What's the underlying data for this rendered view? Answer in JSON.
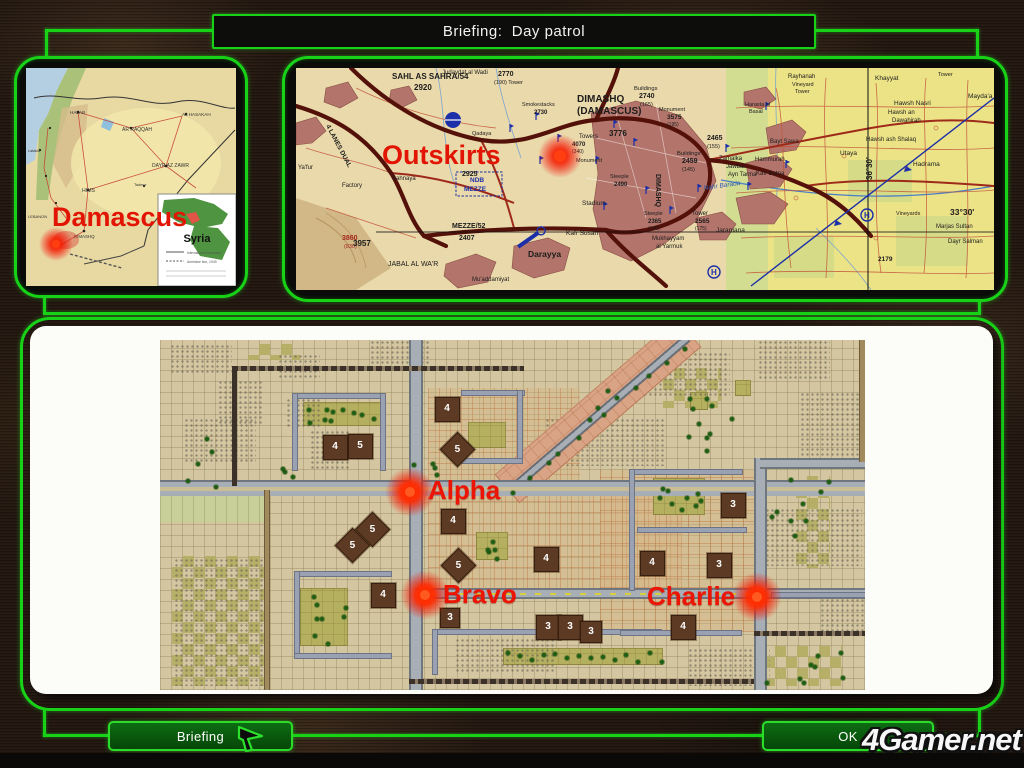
{
  "title": "Briefing:  Day patrol",
  "buttons": {
    "briefing": "Briefing",
    "ok": "OK"
  },
  "watermark": "4Gamer.net",
  "colors": {
    "frame_green": "#18d218",
    "marker_red": "#ec1505",
    "map_tan": "#d3c6a0"
  },
  "syria": {
    "marker": "Damascus",
    "inset": {
      "title": "Syria",
      "legend1": "International boundary",
      "legend2": "Armistice line, 1949"
    },
    "labels": [
      {
        "t": "HALAB",
        "x": 44,
        "y": 46,
        "s": 4.6
      },
      {
        "t": "AR RAQQAH",
        "x": 96,
        "y": 63,
        "s": 5
      },
      {
        "t": "AL HASAKAH",
        "x": 156,
        "y": 48,
        "s": 4.6
      },
      {
        "t": "DAYR AZ ZAWR",
        "x": 126,
        "y": 99,
        "s": 5
      },
      {
        "t": "HIMS",
        "x": 56,
        "y": 124,
        "s": 5.2
      },
      {
        "t": "DIMASHQ",
        "x": 48,
        "y": 170,
        "s": 4.4
      },
      {
        "t": "LEBANON",
        "x": 2,
        "y": 150,
        "s": 4
      },
      {
        "t": "Latakia",
        "x": 2,
        "y": 84,
        "s": 3.8
      },
      {
        "t": "Tadmur",
        "x": 108,
        "y": 118,
        "s": 3.8
      }
    ]
  },
  "detail": {
    "marker": "Outskirts",
    "labels": [
      {
        "t": "SAHL AS SAHRA/54",
        "x": 96,
        "y": 11,
        "s": 8,
        "b": 1
      },
      {
        "t": "2920",
        "x": 118,
        "y": 22,
        "s": 8,
        "b": 1
      },
      {
        "t": "Judaydat al Wadi",
        "x": 146,
        "y": 6,
        "s": 6
      },
      {
        "t": "2770",
        "x": 202,
        "y": 8,
        "s": 7,
        "b": 1
      },
      {
        "t": "(190) Tower",
        "x": 198,
        "y": 16,
        "s": 5.5
      },
      {
        "t": "4 LANES DUAL",
        "x": 30,
        "y": 58,
        "s": 6.5,
        "b": 1,
        "r": 62
      },
      {
        "t": "Factory",
        "x": 46,
        "y": 119,
        "s": 6
      },
      {
        "t": "Ya'fur",
        "x": 2,
        "y": 101,
        "s": 6
      },
      {
        "t": "3860",
        "x": 46,
        "y": 172,
        "s": 7,
        "b": 1,
        "c": "#a3261c"
      },
      {
        "t": "(830)",
        "x": 48,
        "y": 180,
        "s": 5.5,
        "c": "#a3261c"
      },
      {
        "t": "Sahnaya",
        "x": 96,
        "y": 112,
        "s": 6
      },
      {
        "t": "Qadaya",
        "x": 176,
        "y": 67,
        "s": 5.5
      },
      {
        "t": "Smokestacks",
        "x": 226,
        "y": 38,
        "s": 5.5
      },
      {
        "t": "2730",
        "x": 238,
        "y": 46,
        "s": 6,
        "b": 1
      },
      {
        "t": "2925",
        "x": 166,
        "y": 108,
        "s": 7,
        "b": 1
      },
      {
        "t": "NDB",
        "x": 174,
        "y": 114,
        "s": 6.5,
        "b": 1,
        "c": "#1b2fa8"
      },
      {
        "t": "MEZZE",
        "x": 168,
        "y": 123,
        "s": 6.5,
        "b": 1,
        "c": "#1b2fa8"
      },
      {
        "t": "MEZZE/52",
        "x": 156,
        "y": 160,
        "s": 7,
        "b": 1
      },
      {
        "t": "2407",
        "x": 163,
        "y": 172,
        "s": 7,
        "b": 1
      },
      {
        "t": "3957",
        "x": 57,
        "y": 178,
        "s": 8,
        "b": 1
      },
      {
        "t": "JABAL AL WA'R",
        "x": 92,
        "y": 198,
        "s": 7
      },
      {
        "t": "Darayya",
        "x": 232,
        "y": 189,
        "s": 8.5,
        "b": 1
      },
      {
        "t": "Mu'addamiyat",
        "x": 176,
        "y": 213,
        "s": 6
      },
      {
        "t": "Stadium",
        "x": 286,
        "y": 137,
        "s": 6.5
      },
      {
        "t": "Kafr Susah",
        "x": 270,
        "y": 167,
        "s": 6.5
      },
      {
        "t": "DIMASHQ",
        "x": 281,
        "y": 34,
        "s": 10,
        "b": 1
      },
      {
        "t": "(DAMASCUS)",
        "x": 281,
        "y": 46,
        "s": 10,
        "b": 1
      },
      {
        "t": "Buildings",
        "x": 338,
        "y": 22,
        "s": 5.8
      },
      {
        "t": "2740",
        "x": 343,
        "y": 30,
        "s": 7,
        "b": 1
      },
      {
        "t": "(165)",
        "x": 344,
        "y": 38,
        "s": 5.5
      },
      {
        "t": "Towers",
        "x": 283,
        "y": 70,
        "s": 6
      },
      {
        "t": "3776",
        "x": 313,
        "y": 68,
        "s": 8,
        "b": 1
      },
      {
        "t": "4070",
        "x": 276,
        "y": 78,
        "s": 6,
        "b": 1
      },
      {
        "t": "(340)",
        "x": 276,
        "y": 85,
        "s": 5
      },
      {
        "t": "Monument",
        "x": 280,
        "y": 94,
        "s": 5.5
      },
      {
        "t": "Monument",
        "x": 363,
        "y": 43,
        "s": 5.5
      },
      {
        "t": "3575",
        "x": 371,
        "y": 51,
        "s": 6.5,
        "b": 1
      },
      {
        "t": "(195)",
        "x": 371,
        "y": 58,
        "s": 5
      },
      {
        "t": "Buildings",
        "x": 381,
        "y": 87,
        "s": 5.8
      },
      {
        "t": "2459",
        "x": 386,
        "y": 95,
        "s": 7,
        "b": 1
      },
      {
        "t": "(145)",
        "x": 386,
        "y": 103,
        "s": 5.5
      },
      {
        "t": "2465",
        "x": 411,
        "y": 72,
        "s": 7,
        "b": 1
      },
      {
        "t": "(155)",
        "x": 411,
        "y": 80,
        "s": 5.5
      },
      {
        "t": "Zamalka",
        "x": 423,
        "y": 92,
        "s": 6
      },
      {
        "t": "Jawbar",
        "x": 430,
        "y": 100,
        "s": 6
      },
      {
        "t": "Ayn Tarma",
        "x": 432,
        "y": 108,
        "s": 6
      },
      {
        "t": "DIMASHQ",
        "x": 360,
        "y": 106,
        "s": 7,
        "b": 1,
        "r": 90
      },
      {
        "t": "Mukhayyam",
        "x": 356,
        "y": 172,
        "s": 6
      },
      {
        "t": "al Yarmuk",
        "x": 360,
        "y": 180,
        "s": 6
      },
      {
        "t": "Steeple",
        "x": 314,
        "y": 110,
        "s": 5.5
      },
      {
        "t": "2490",
        "x": 318,
        "y": 118,
        "s": 6,
        "b": 1
      },
      {
        "t": "Steeple",
        "x": 348,
        "y": 147,
        "s": 5.5
      },
      {
        "t": "2365",
        "x": 352,
        "y": 155,
        "s": 6,
        "b": 1
      },
      {
        "t": "(140)",
        "x": 352,
        "y": 162,
        "s": 5
      },
      {
        "t": "Tower",
        "x": 396,
        "y": 147,
        "s": 6
      },
      {
        "t": "2565",
        "x": 399,
        "y": 155,
        "s": 6.5,
        "b": 1
      },
      {
        "t": "(175)",
        "x": 399,
        "y": 162,
        "s": 5
      },
      {
        "t": "Jaramana",
        "x": 420,
        "y": 164,
        "s": 6.5
      },
      {
        "t": "Nahr Barada",
        "x": 408,
        "y": 122,
        "s": 6.5,
        "c": "#2a5cb0",
        "i": 1,
        "r": -8
      },
      {
        "t": "Harasta al",
        "x": 449,
        "y": 38,
        "s": 5.5
      },
      {
        "t": "Basal",
        "x": 453,
        "y": 45,
        "s": 5.5
      },
      {
        "t": "Hammurah",
        "x": 459,
        "y": 93,
        "s": 6
      },
      {
        "t": "Kafr Batna",
        "x": 460,
        "y": 107,
        "s": 6
      },
      {
        "t": "Bayt Sawa",
        "x": 474,
        "y": 75,
        "s": 6
      },
      {
        "t": "Rayhanah",
        "x": 492,
        "y": 10,
        "s": 6
      },
      {
        "t": "Vineyard",
        "x": 496,
        "y": 18,
        "s": 5.5
      },
      {
        "t": "Tower",
        "x": 499,
        "y": 25,
        "s": 5.5
      },
      {
        "t": "Khayyat",
        "x": 579,
        "y": 12,
        "s": 6.5
      },
      {
        "t": "Tower",
        "x": 642,
        "y": 8,
        "s": 5.5
      },
      {
        "t": "Hawsh Nasri",
        "x": 598,
        "y": 37,
        "s": 6.5
      },
      {
        "t": "Hawsh an",
        "x": 592,
        "y": 46,
        "s": 6
      },
      {
        "t": "Dawahirah",
        "x": 596,
        "y": 54,
        "s": 6
      },
      {
        "t": "Hawsh ash Shalaq",
        "x": 570,
        "y": 73,
        "s": 6
      },
      {
        "t": "Utaya",
        "x": 544,
        "y": 87,
        "s": 6.5
      },
      {
        "t": "Hadrama",
        "x": 617,
        "y": 98,
        "s": 6.5
      },
      {
        "t": "Mayda'a",
        "x": 672,
        "y": 30,
        "s": 6.5
      },
      {
        "t": "Marjas Sultan",
        "x": 640,
        "y": 160,
        "s": 6
      },
      {
        "t": "Dayr Salman",
        "x": 652,
        "y": 175,
        "s": 6
      },
      {
        "t": "Al Mulayhah",
        "x": 630,
        "y": 165,
        "s": 0
      },
      {
        "t": "Vineyards",
        "x": 600,
        "y": 147,
        "s": 5.5
      },
      {
        "t": "2179",
        "x": 582,
        "y": 193,
        "s": 6.5,
        "b": 1
      },
      {
        "t": "36°30'",
        "x": 576,
        "y": 112,
        "s": 8,
        "b": 1,
        "r": -90
      },
      {
        "t": "33°30'",
        "x": 654,
        "y": 147,
        "s": 8.5,
        "b": 1
      },
      {
        "t": "H",
        "x": 415,
        "y": 207,
        "s": 8,
        "b": 1,
        "c": "#1b2fa8"
      },
      {
        "t": "H",
        "x": 568,
        "y": 150,
        "s": 8,
        "b": 1,
        "c": "#1b2fa8"
      }
    ]
  },
  "tactical": {
    "fields": [
      {
        "x": 268,
        "y": 48,
        "w": 152,
        "h": 98,
        "c": "paved"
      },
      {
        "x": 268,
        "y": 154,
        "w": 254,
        "h": 96,
        "c": "paved"
      },
      {
        "x": 440,
        "y": 130,
        "w": 160,
        "h": 162,
        "c": "paved"
      },
      {
        "x": 143,
        "y": 62,
        "w": 80,
        "h": 24,
        "c": "olive"
      },
      {
        "x": 0,
        "y": 156,
        "w": 110,
        "h": 26,
        "c": "lgreen"
      },
      {
        "x": 140,
        "y": 248,
        "w": 48,
        "h": 58,
        "c": "olive"
      },
      {
        "x": 316,
        "y": 192,
        "w": 32,
        "h": 28,
        "c": "olive"
      },
      {
        "x": 493,
        "y": 138,
        "w": 52,
        "h": 37,
        "c": "olive"
      },
      {
        "x": 343,
        "y": 308,
        "w": 160,
        "h": 17,
        "c": "olive"
      },
      {
        "x": 308,
        "y": 82,
        "w": 38,
        "h": 26,
        "c": "olive"
      },
      {
        "x": 503,
        "y": 28,
        "w": 58,
        "h": 40,
        "c": "olive2"
      },
      {
        "x": 636,
        "y": 136,
        "w": 34,
        "h": 92,
        "c": "olive2"
      },
      {
        "x": 604,
        "y": 306,
        "w": 78,
        "h": 40,
        "c": "olive2"
      },
      {
        "x": 88,
        "y": 4,
        "w": 52,
        "h": 16,
        "c": "olive2"
      },
      {
        "x": 12,
        "y": 216,
        "w": 92,
        "h": 130,
        "c": "olive2"
      },
      {
        "x": 530,
        "y": 52,
        "w": 18,
        "h": 18,
        "c": "olive"
      },
      {
        "x": 575,
        "y": 40,
        "w": 16,
        "h": 16,
        "c": "olive"
      }
    ],
    "rough": [
      [
        10,
        4,
        62,
        30
      ],
      [
        58,
        40,
        46,
        44
      ],
      [
        118,
        14,
        42,
        26
      ],
      [
        24,
        78,
        72,
        46
      ],
      [
        126,
        58,
        36,
        30
      ],
      [
        150,
        90,
        40,
        40
      ],
      [
        210,
        0,
        60,
        26
      ],
      [
        385,
        78,
        120,
        48
      ],
      [
        478,
        12,
        92,
        44
      ],
      [
        598,
        0,
        72,
        40
      ],
      [
        640,
        52,
        64,
        76
      ],
      [
        600,
        168,
        102,
        58
      ],
      [
        14,
        218,
        92,
        128
      ],
      [
        295,
        298,
        100,
        34
      ],
      [
        528,
        308,
        82,
        38
      ],
      [
        660,
        253,
        44,
        42
      ]
    ],
    "roads": [
      {
        "x": 347,
        "y": 130,
        "w": 240,
        "h": 38,
        "t": "salmon",
        "r": -40.7
      },
      {
        "x": 350,
        "y": 146,
        "w": 234,
        "h": 9,
        "t": "diagroad",
        "r": -40.7
      },
      {
        "x": 0,
        "y": 140,
        "w": 705,
        "h": 16,
        "t": "rmain"
      },
      {
        "x": 249,
        "y": 0,
        "w": 14,
        "h": 350,
        "t": "rv"
      },
      {
        "x": 255,
        "y": 248,
        "w": 450,
        "h": 11,
        "t": "ryellow"
      },
      {
        "x": 594,
        "y": 118,
        "w": 13,
        "h": 232,
        "t": "rv"
      },
      {
        "x": 600,
        "y": 118,
        "w": 105,
        "h": 11,
        "t": "rh"
      },
      {
        "x": 699,
        "y": 0,
        "w": 7,
        "h": 122,
        "t": "dirtv"
      },
      {
        "x": 104,
        "y": 150,
        "w": 6,
        "h": 200,
        "t": "dirtv"
      },
      {
        "x": 594,
        "y": 291,
        "w": 111,
        "h": 5,
        "t": "rail"
      },
      {
        "x": 249,
        "y": 339,
        "w": 345,
        "h": 5,
        "t": "rail"
      },
      {
        "x": 72,
        "y": 26,
        "w": 292,
        "h": 5,
        "t": "rail"
      },
      {
        "x": 72,
        "y": 26,
        "w": 5,
        "h": 120,
        "t": "rail"
      }
    ],
    "walls": [
      [
        133,
        54,
        92,
        4
      ],
      [
        133,
        54,
        4,
        76
      ],
      [
        221,
        54,
        4,
        76
      ],
      [
        302,
        51,
        62,
        4
      ],
      [
        358,
        51,
        4,
        72
      ],
      [
        302,
        119,
        60,
        4
      ],
      [
        135,
        232,
        96,
        4
      ],
      [
        135,
        232,
        4,
        86
      ],
      [
        135,
        314,
        96,
        4
      ],
      [
        273,
        290,
        228,
        4
      ],
      [
        273,
        290,
        4,
        44
      ],
      [
        470,
        130,
        112,
        4
      ],
      [
        470,
        130,
        4,
        120
      ],
      [
        478,
        188,
        108,
        4
      ],
      [
        461,
        291,
        120,
        4
      ],
      [
        612,
        253,
        93,
        4
      ]
    ],
    "trees": [
      {
        "x": 147,
        "y": 64,
        "w": 72,
        "h": 20,
        "n": 10
      },
      {
        "x": 148,
        "y": 252,
        "w": 38,
        "h": 50,
        "n": 8
      },
      {
        "x": 497,
        "y": 142,
        "w": 46,
        "h": 30,
        "n": 9
      },
      {
        "x": 318,
        "y": 196,
        "w": 28,
        "h": 22,
        "n": 5
      },
      {
        "x": 346,
        "y": 310,
        "w": 154,
        "h": 10,
        "n": 14,
        "row": true
      },
      {
        "x": 4,
        "y": 96,
        "w": 150,
        "h": 56,
        "n": 8
      },
      {
        "x": 610,
        "y": 130,
        "w": 60,
        "h": 105,
        "n": 9
      },
      {
        "x": 604,
        "y": 310,
        "w": 80,
        "h": 34,
        "n": 8
      },
      {
        "x": 428,
        "y": 34,
        "w": 120,
        "h": 60,
        "n": 7
      },
      {
        "x": 248,
        "y": 120,
        "w": 40,
        "h": 24,
        "n": 4
      },
      {
        "x": 520,
        "y": 60,
        "w": 60,
        "h": 50,
        "n": 5
      }
    ],
    "diag_trees": 12,
    "buildings": [
      [
        175,
        107,
        "4",
        0
      ],
      [
        200,
        106,
        "5",
        0
      ],
      [
        287,
        69,
        "4",
        0
      ],
      [
        297,
        109,
        "5",
        1
      ],
      [
        192,
        205,
        "5",
        1
      ],
      [
        212,
        189,
        "5",
        1
      ],
      [
        293,
        181,
        "4",
        0
      ],
      [
        298,
        225,
        "5",
        1
      ],
      [
        223,
        255,
        "4",
        0
      ],
      [
        290,
        278,
        "3",
        0,
        20
      ],
      [
        386,
        219,
        "4",
        0
      ],
      [
        388,
        287,
        "3",
        0
      ],
      [
        410,
        287,
        "3",
        0
      ],
      [
        431,
        292,
        "3",
        0,
        22
      ],
      [
        492,
        223,
        "4",
        0
      ],
      [
        573,
        165,
        "3",
        0
      ],
      [
        559,
        225,
        "3",
        0
      ],
      [
        523,
        287,
        "4",
        0
      ]
    ],
    "markers": [
      {
        "t": "Alpha",
        "bx": 250,
        "by": 152,
        "tx": 268,
        "ty": 135
      },
      {
        "t": "Bravo",
        "bx": 265,
        "by": 255,
        "tx": 283,
        "ty": 239
      },
      {
        "t": "Charlie",
        "bx": 597,
        "by": 257,
        "tx": 487,
        "ty": 241
      }
    ]
  }
}
